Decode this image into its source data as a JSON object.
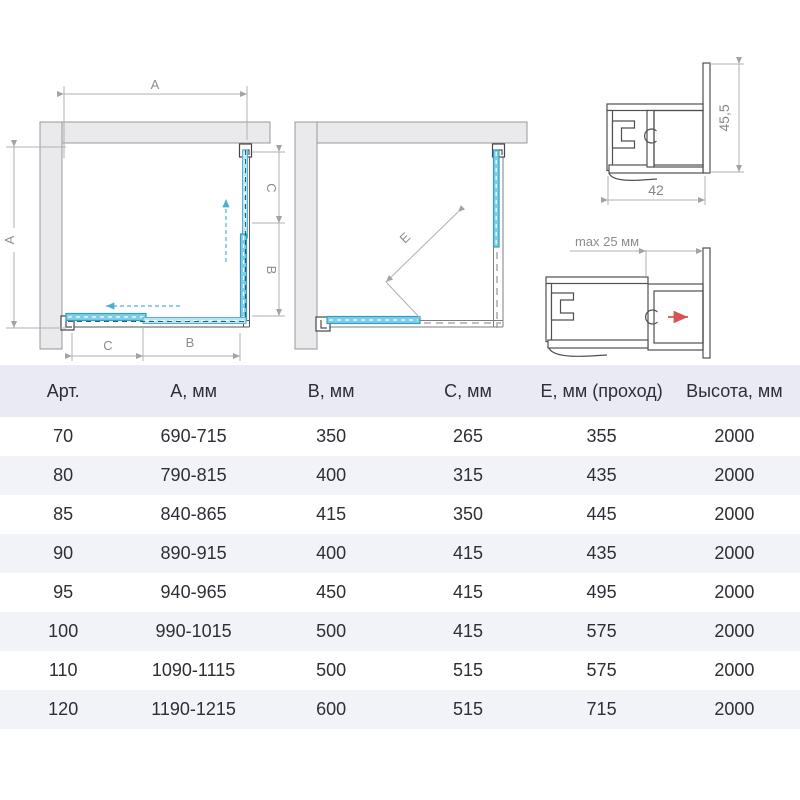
{
  "diagrams": {
    "labels": {
      "a": "A",
      "b": "B",
      "c": "C",
      "e": "E",
      "profile_height": "45,5",
      "profile_width": "42",
      "max_adjust": "max 25 мм"
    },
    "colors": {
      "glass_stroke": "#2f9fc6",
      "glass_fill": "#7fcde8",
      "wall_fill": "#eaeaec",
      "dimension": "#b0b0b3",
      "red_arrow": "#d9534f",
      "header_bg": "#e9eaf2",
      "row_stripe_bg": "#f2f3f9"
    }
  },
  "table": {
    "headers": [
      "Арт.",
      "А, мм",
      "В, мм",
      "С, мм",
      "Е, мм (проход)",
      "Высота, мм"
    ],
    "rows": [
      [
        "70",
        "690-715",
        "350",
        "265",
        "355",
        "2000"
      ],
      [
        "80",
        "790-815",
        "400",
        "315",
        "435",
        "2000"
      ],
      [
        "85",
        "840-865",
        "415",
        "350",
        "445",
        "2000"
      ],
      [
        "90",
        "890-915",
        "400",
        "415",
        "435",
        "2000"
      ],
      [
        "95",
        "940-965",
        "450",
        "415",
        "495",
        "2000"
      ],
      [
        "100",
        "990-1015",
        "500",
        "415",
        "575",
        "2000"
      ],
      [
        "110",
        "1090-1115",
        "500",
        "515",
        "575",
        "2000"
      ],
      [
        "120",
        "1190-1215",
        "600",
        "515",
        "715",
        "2000"
      ]
    ]
  }
}
